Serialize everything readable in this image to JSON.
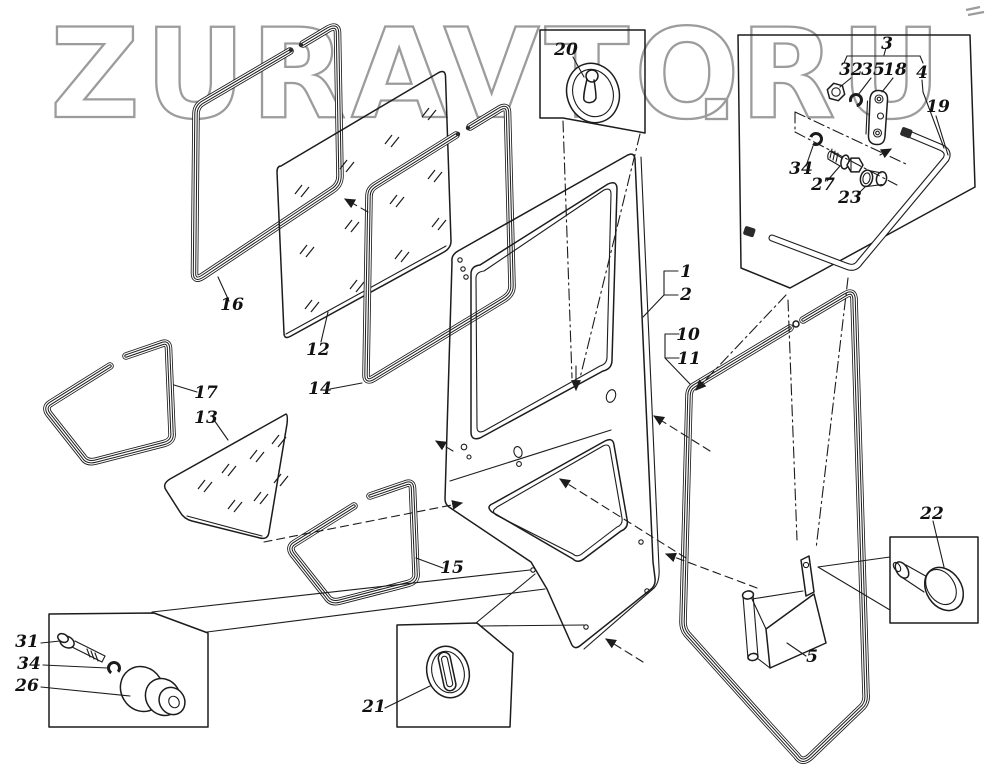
{
  "watermark": {
    "left": "ZURAVTO",
    "right": "RU",
    "color": "#9c9c9c"
  },
  "drawing": {
    "ink": "#1c1c1c",
    "paper": "#ffffff",
    "type": "exploded-parts-diagram",
    "subject": "cab door assembly with glazing, seals and hardware"
  },
  "labels": {
    "p1": "1",
    "p2": "2",
    "p3": "3",
    "p4": "4",
    "p5": "5",
    "p10": "10",
    "p11": "11",
    "p12": "12",
    "p13": "13",
    "p14": "14",
    "p15": "15",
    "p16": "16",
    "p17": "17",
    "p18": "18",
    "p19": "19",
    "p20": "20",
    "p21": "21",
    "p22": "22",
    "p23": "23",
    "p26": "26",
    "p27": "27",
    "p31": "31",
    "p32": "32",
    "p34a": "34",
    "p34b": "34",
    "p35": "35"
  }
}
